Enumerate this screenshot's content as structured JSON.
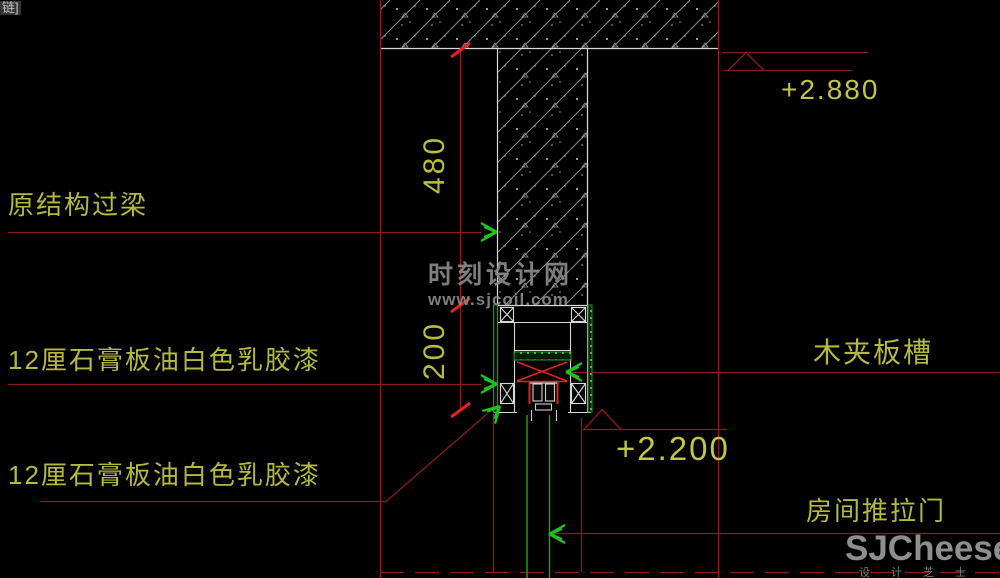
{
  "window": {
    "corner_fragment": "链]"
  },
  "annotations": {
    "lintel_label": "原结构过梁",
    "gypsum_label_top": "12厘石膏板油白色乳胶漆",
    "gypsum_label_bottom": "12厘石膏板油白色乳胶漆",
    "plywood_groove_label": "木夹板槽",
    "sliding_door_label": "房间推拉门"
  },
  "dimensions": {
    "lintel_height": "480",
    "pocket_height": "200"
  },
  "levels": {
    "upper": "+2.880",
    "lower": "+2.200"
  },
  "watermark": {
    "site_name": "时刻设计网",
    "site_url": "www.sjcoil.com"
  },
  "brand": {
    "logo": "SJCheese",
    "tagline": "设计芝士"
  },
  "colors": {
    "annotation_text": "#b5b93c",
    "leader_line": "#8e1a1a",
    "highlight_red": "#e32222",
    "drawing_line": "#d9d9d9",
    "green_accent": "#1fc21f",
    "hatch_gray": "#8d8d8d",
    "watermark_gray": "#8c8c8c"
  }
}
